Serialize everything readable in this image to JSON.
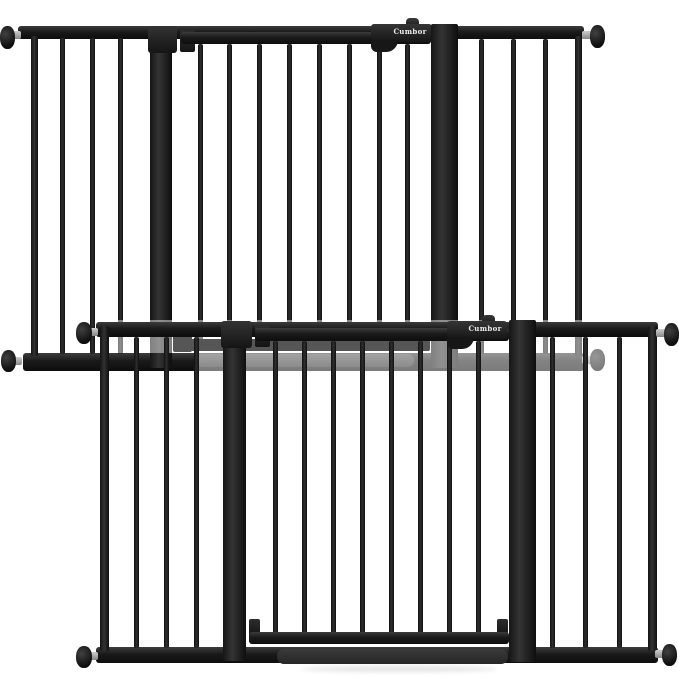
{
  "scene": {
    "description": "Product photo of two black metal walk-through baby safety gates on a white background, overlapping diagonally",
    "background_color": "#ffffff"
  },
  "brand": {
    "label": "Cumbor",
    "text_color": "#ededed"
  },
  "colors": {
    "gate_black": "#1a1a1a",
    "rear_gate_gray": "#6e6e6e",
    "pressure_bolt_shaft_silver": "#b5b5b5",
    "door_threshold_dark": "#2e2e2e",
    "rear_threshold_light": "#989898"
  },
  "products": [
    {
      "id": "top-gate",
      "position": "upper-left",
      "finish": "black",
      "brand_label": "Cumbor"
    },
    {
      "id": "bottom-gate",
      "position": "lower-right",
      "finish": "black",
      "brand_label": "Cumbor"
    }
  ]
}
